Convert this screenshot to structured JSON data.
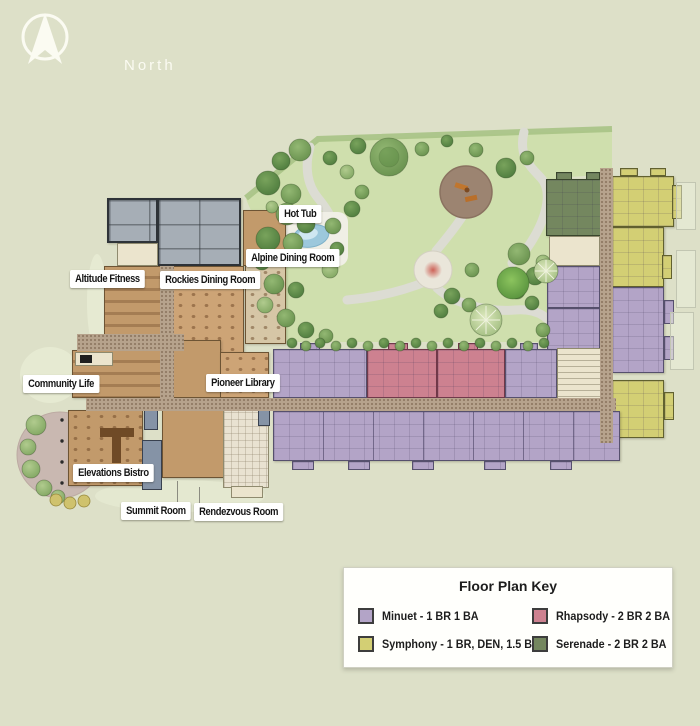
{
  "compass": {
    "label": "North"
  },
  "plan_labels": {
    "hot_tub": "Hot Tub",
    "alpine": "Alpine Dining Room",
    "altitude": "Altitude Fitness",
    "rockies": "Rockies Dining Room",
    "community": "Community Life",
    "pioneer": "Pioneer Library",
    "bistro": "Elevations Bistro",
    "summit": "Summit Room",
    "rendezvous": "Rendezvous Room"
  },
  "legend": {
    "title": "Floor Plan Key",
    "entries": [
      {
        "id": "minuet",
        "label": "Minuet - 1 BR 1 BA"
      },
      {
        "id": "rhapsody",
        "label": "Rhapsody - 2 BR 2 BA"
      },
      {
        "id": "symphony",
        "label": "Symphony - 1 BR, DEN, 1.5 BA"
      },
      {
        "id": "serenade",
        "label": "Serenade - 2 BR 2 BA"
      }
    ]
  },
  "colors": {
    "minuet": "#b3a4c7",
    "symphony": "#d3cf74",
    "rhapsody": "#cd8190",
    "serenade": "#74875f",
    "background": "#dde0c8",
    "lawn": "#cfdfad"
  }
}
